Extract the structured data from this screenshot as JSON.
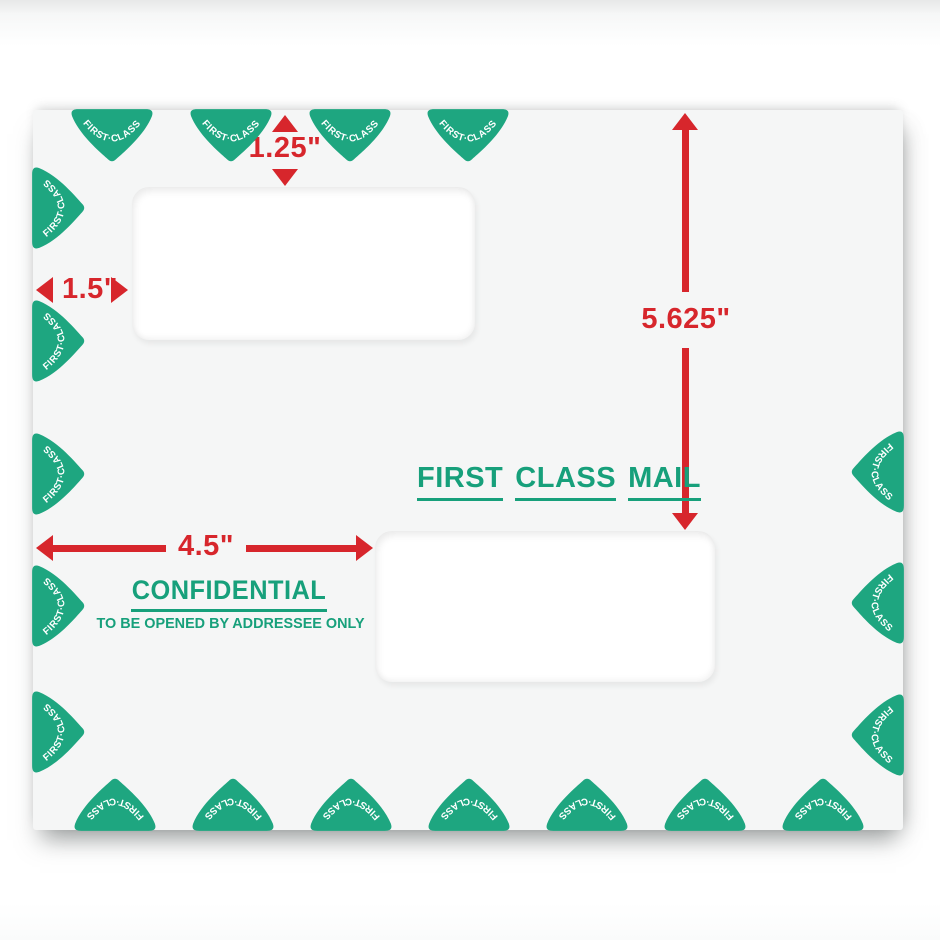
{
  "colors": {
    "red": "#d7262c",
    "green_text": "#17a07b",
    "green_shape": "#1ea680",
    "envelope_bg": "#f5f6f6"
  },
  "dimensions": {
    "top_window_drop": "1.25\"",
    "left_margin": "1.5\"",
    "top_to_lower_window": "5.625\"",
    "left_to_lower_window": "4.5\""
  },
  "stamps": {
    "first_class_words": [
      "FIRST",
      "CLASS",
      "MAIL"
    ],
    "confidential": "CONFIDENTIAL",
    "addressee_note": "TO BE OPENED BY ADDRESSEE ONLY"
  },
  "border_badges": {
    "label": "FIRST·CLASS",
    "top": [
      79,
      198,
      317,
      435
    ],
    "left": [
      98,
      231,
      364,
      496,
      622
    ],
    "right": [
      362,
      493,
      625
    ],
    "bottom": [
      82,
      200,
      318,
      436,
      554,
      672,
      790
    ]
  }
}
